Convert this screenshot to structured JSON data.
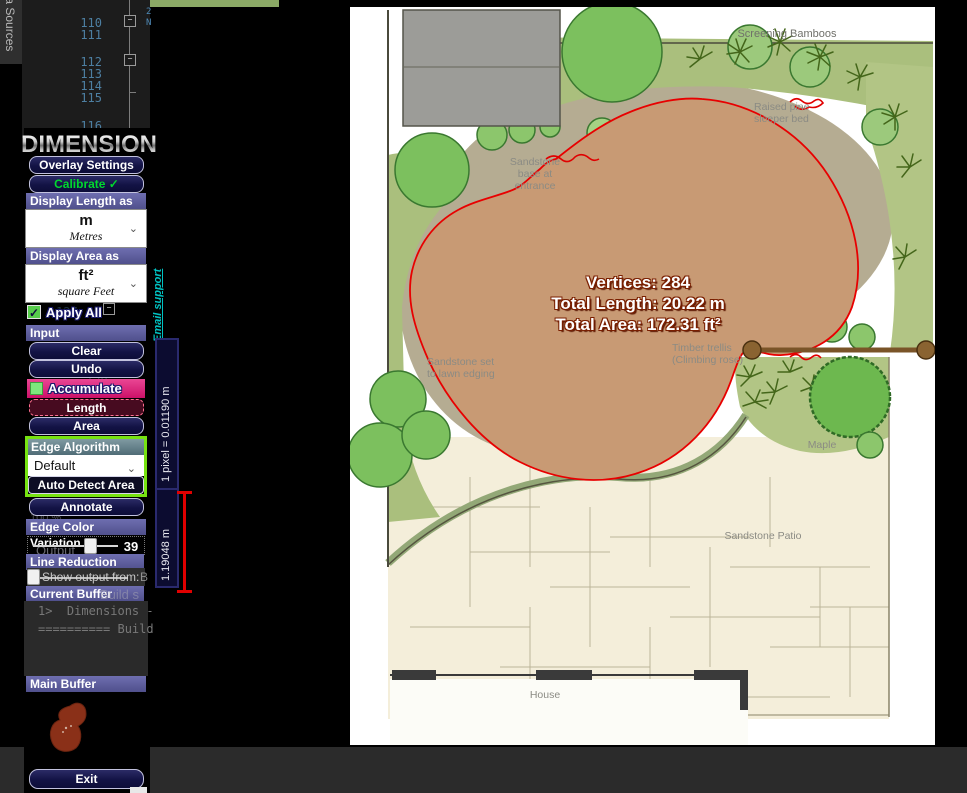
{
  "editor": {
    "vertical_tab": "ta Sources",
    "line_numbers": [
      "110",
      "111",
      "112",
      "113",
      "114",
      "115",
      "116",
      "117"
    ],
    "ghost_line_numbers": [
      "127",
      "128",
      "129",
      "130"
    ],
    "code_fragment_1": "2",
    "code_fragment_2": "N"
  },
  "panel": {
    "logo": "DIMENSIONS",
    "overlay_settings": "Overlay Settings",
    "calibrate": "Calibrate ✓",
    "display_length_label": "Display Length as",
    "length_unit": "m",
    "length_unit_name": "Metres",
    "display_area_label": "Display Area as",
    "area_unit": "ft²",
    "area_unit_name": "square Feet",
    "apply_all": "Apply All",
    "apply_all_check": "✓",
    "input_label": "Input",
    "clear": "Clear",
    "undo": "Undo",
    "accumulate": "Accumulate",
    "length": "Length",
    "area": "Area",
    "edge_algorithm_label": "Edge Algorithm",
    "edge_algorithm_value": "Default",
    "auto_detect_area": "Auto Detect Area",
    "annotate": "Annotate",
    "edge_color_variation_label": "Edge Color Variation",
    "edge_color_variation_value": "39",
    "line_reduction_label": "Line Reduction",
    "current_buffer_label": "Current Buffer",
    "main_buffer_label": "Main Buffer",
    "exit": "Exit",
    "email_support": "Email support",
    "chevron": "⌄"
  },
  "vs_output": {
    "zoom_level": "100 %",
    "output_header": "Output",
    "show_output_from": "Show output from:",
    "dropdown_fragment": "B",
    "buffer_ghost": "Build s",
    "console_line_1": "1>  Dimensions -",
    "console_line_2": "========== Build"
  },
  "ruler": {
    "scale_label": "1 pixel = 0.01190 m",
    "segment_label": "1.19048 m"
  },
  "measurement": {
    "vertices": "Vertices: 284",
    "total_length": "Total Length: 20.22 m",
    "total_area": "Total Area: 172.31 ft²"
  },
  "plan": {
    "screening_bamboos": "Screening Bamboos",
    "raised_bed_line1": "Raised pine",
    "raised_bed_line2": "sleeper bed",
    "entrance_line1": "Sandstone",
    "entrance_line2": "base at",
    "entrance_line3": "entrance",
    "edging_line1": "Sandstone set",
    "edging_line2": "to lawn edging",
    "trellis_line1": "Timber trellis",
    "trellis_line2": "(Climbing rose)",
    "maple": "Maple",
    "patio": "Sandstone Patio",
    "house": "House"
  },
  "colors": {
    "accent_purple": "#5b5b99",
    "button_navy": "#14143f",
    "calibrate_green": "#00d82e",
    "accumulate_pink": "#e01f78",
    "edge_box_green": "#77e311",
    "outline_red": "#e80000",
    "lawn_tan": "#c79a74",
    "email_teal": "#00c2c2"
  }
}
